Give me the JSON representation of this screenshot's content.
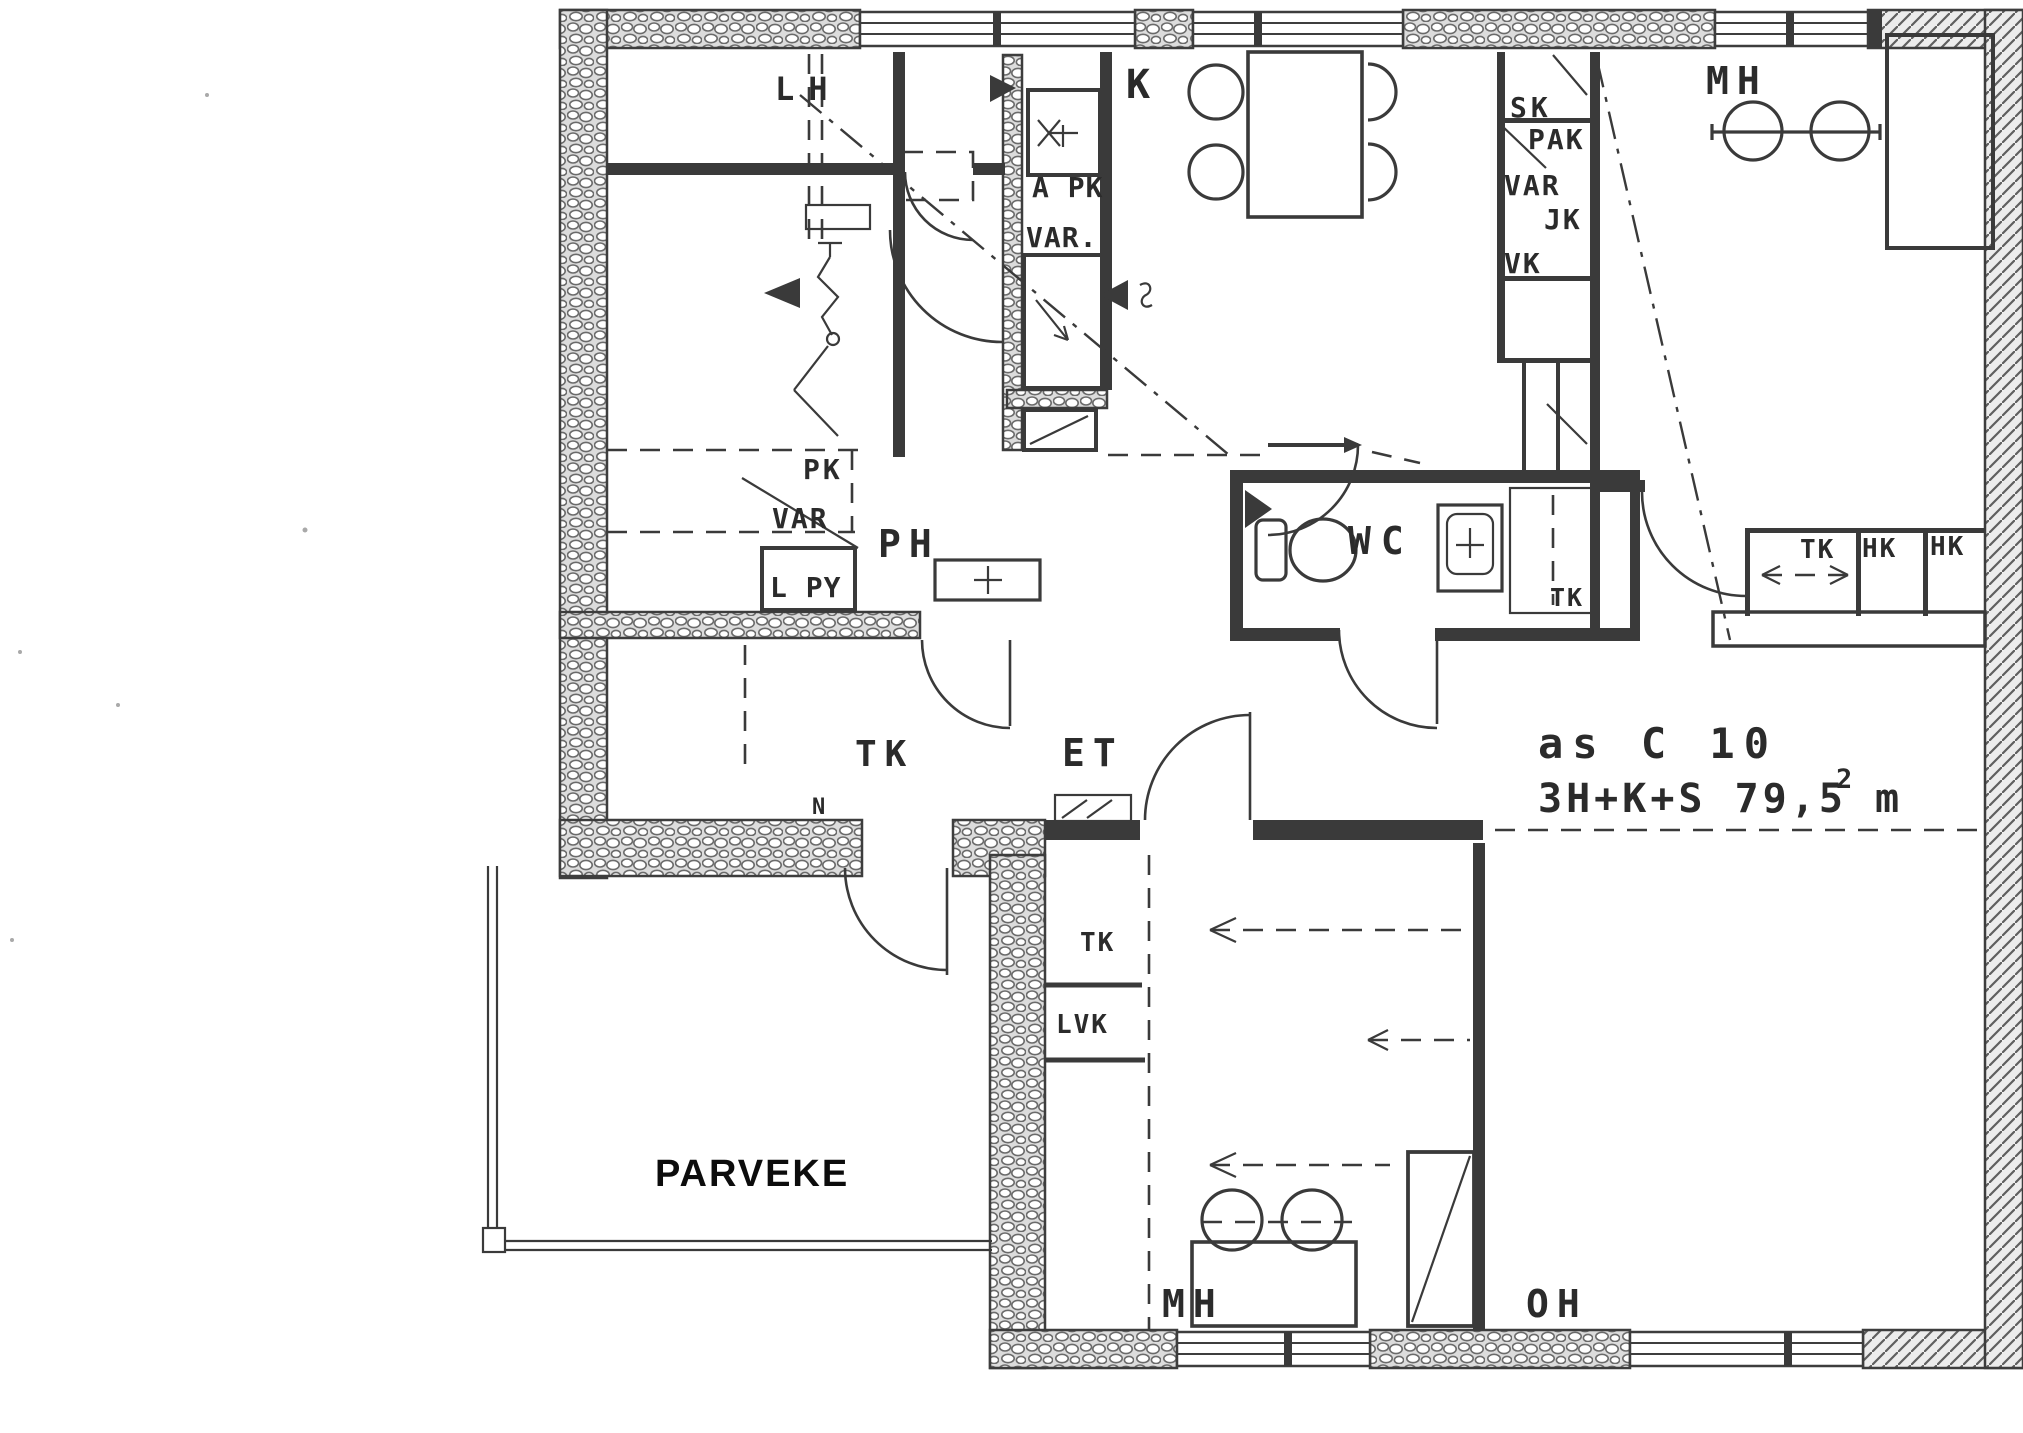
{
  "apartment": {
    "unit": "as C 10",
    "layout_area": "3H+K+S  79,5 m",
    "area_superscript": "2"
  },
  "balcony_label": "PARVEKE",
  "rooms": {
    "sauna": "LH",
    "kitchen": "K",
    "bedroom_top": "MH",
    "washroom": "PH",
    "toilet": "WC",
    "hall": "ET",
    "closet_room_tk": "TK",
    "bedroom_bottom": "MH",
    "living_room": "OH"
  },
  "closets": {
    "sk": "SK",
    "pak": "PAK",
    "var_top": "VAR",
    "jk": "JK",
    "vk": "VK",
    "apk": "A PK",
    "var_mid": "VAR.",
    "pk_left": "PK",
    "var_left": "VAR",
    "lpy": "L PY",
    "tk_wc": "TK",
    "tk_mh": "TK",
    "hk_1": "HK",
    "hk_2": "HK",
    "tk_bottom": "TK",
    "lvk": "LVK",
    "north_mark": "N"
  }
}
